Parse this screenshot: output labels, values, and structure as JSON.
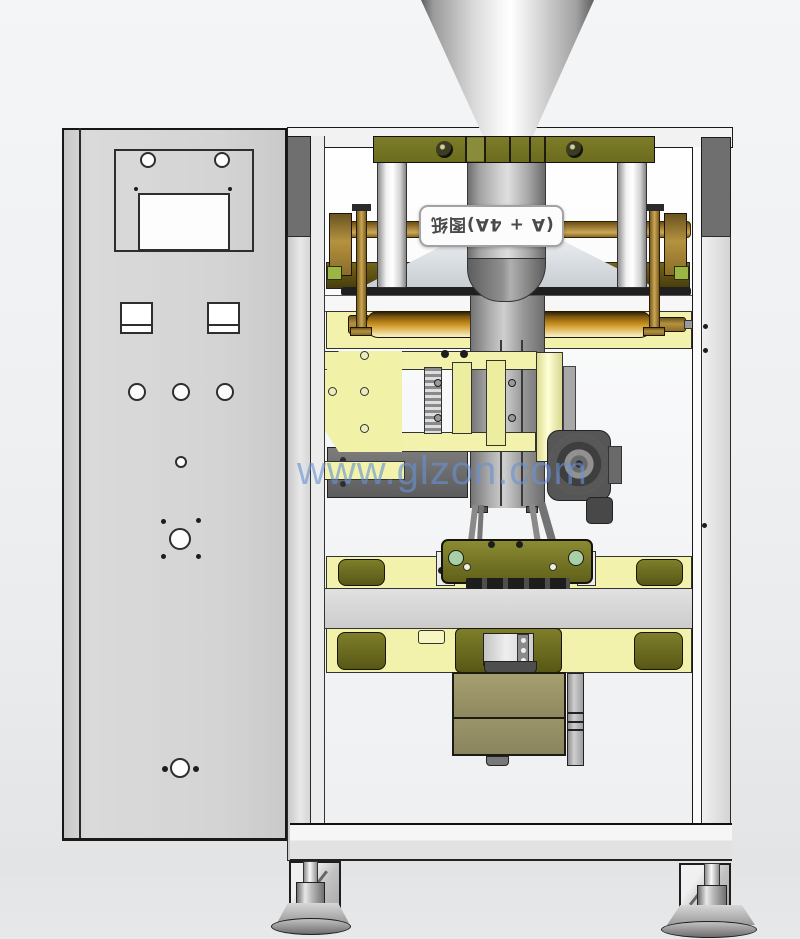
{
  "watermark": {
    "text": "www.glzon.com",
    "color": "#6892d4"
  },
  "view_label": {
    "text": "(A + 4A)图纸",
    "rotation_deg": 180
  },
  "colors": {
    "background": "#eef0f2",
    "frame_dark": "#6f6f6f",
    "frame_light": "#e9e9e9",
    "cabinet_gray": "#d4d4d4",
    "plate_olive": "#6c6c20",
    "band_yellow": "#f2f2ac",
    "roller_orange": "#d6a237",
    "brass": "#b5923f",
    "tube_gray": "#a8a8a8",
    "brown_band": "#5e5014",
    "chute_tan": "#9a9467",
    "blower_dark": "#565656",
    "accent_green": "#9cb645"
  }
}
